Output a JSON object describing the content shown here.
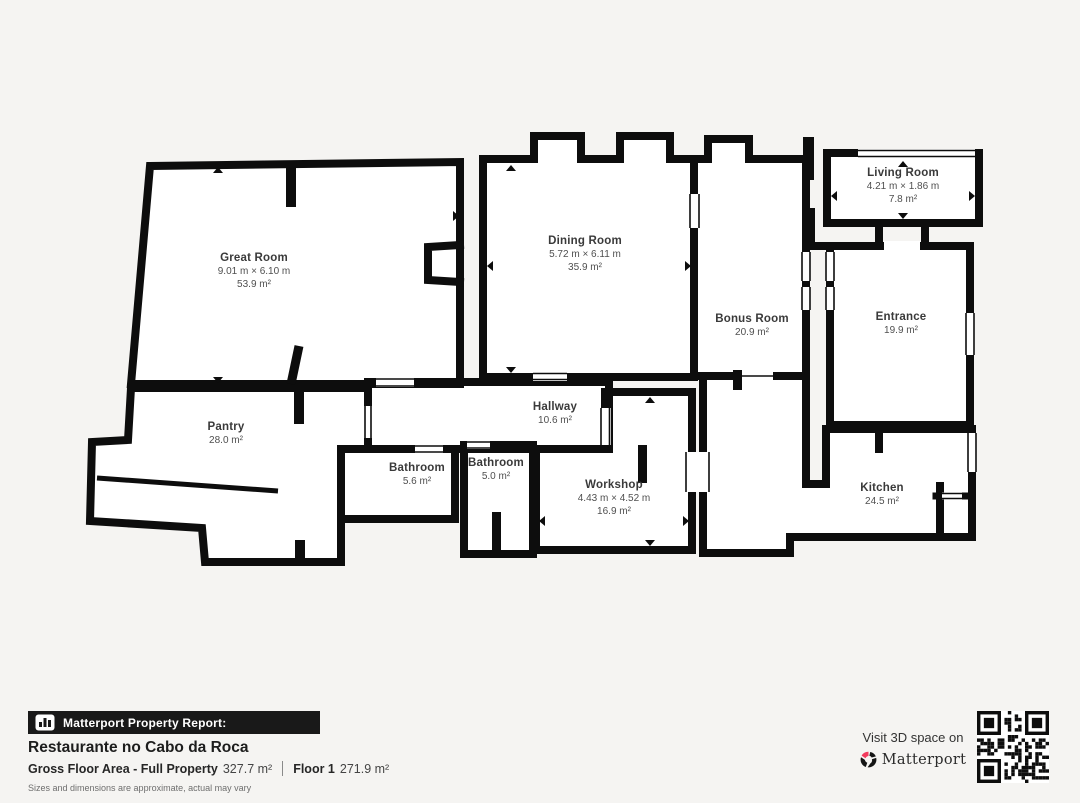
{
  "plan": {
    "rooms": [
      {
        "id": "great-room",
        "name": "Great Room",
        "dims": "9.01 m × 6.10 m",
        "area": "53.9 m²"
      },
      {
        "id": "dining-room",
        "name": "Dining Room",
        "dims": "5.72 m × 6.11 m",
        "area": "35.9 m²"
      },
      {
        "id": "living-room",
        "name": "Living Room",
        "dims": "4.21 m × 1.86 m",
        "area": "7.8 m²"
      },
      {
        "id": "bonus-room",
        "name": "Bonus Room",
        "dims": "",
        "area": "20.9 m²"
      },
      {
        "id": "entrance",
        "name": "Entrance",
        "dims": "",
        "area": "19.9 m²"
      },
      {
        "id": "pantry",
        "name": "Pantry",
        "dims": "",
        "area": "28.0 m²"
      },
      {
        "id": "hallway",
        "name": "Hallway",
        "dims": "",
        "area": "10.6 m²"
      },
      {
        "id": "bathroom-1",
        "name": "Bathroom",
        "dims": "",
        "area": "5.6 m²"
      },
      {
        "id": "bathroom-2",
        "name": "Bathroom",
        "dims": "",
        "area": "5.0 m²"
      },
      {
        "id": "workshop",
        "name": "Workshop",
        "dims": "4.43 m × 4.52 m",
        "area": "16.9 m²"
      },
      {
        "id": "kitchen",
        "name": "Kitchen",
        "dims": "",
        "area": "24.5 m²"
      }
    ]
  },
  "footer": {
    "report_label": "Matterport Property Report:",
    "property_name": "Restaurante no Cabo da Roca",
    "gross_label": "Gross Floor Area - Full Property",
    "gross_value": "327.7 m²",
    "floor_label": "Floor 1",
    "floor_value": "271.9 m²",
    "disclaimer": "Sizes and dimensions are approximate, actual may vary"
  },
  "cta": {
    "visit_text": "Visit 3D space on",
    "brand": "Matterport"
  },
  "colors": {
    "background": "#f5f4f2",
    "wall": "#0d0d0d",
    "brand_pink": "#f23a5d",
    "bar_black": "#191919"
  }
}
